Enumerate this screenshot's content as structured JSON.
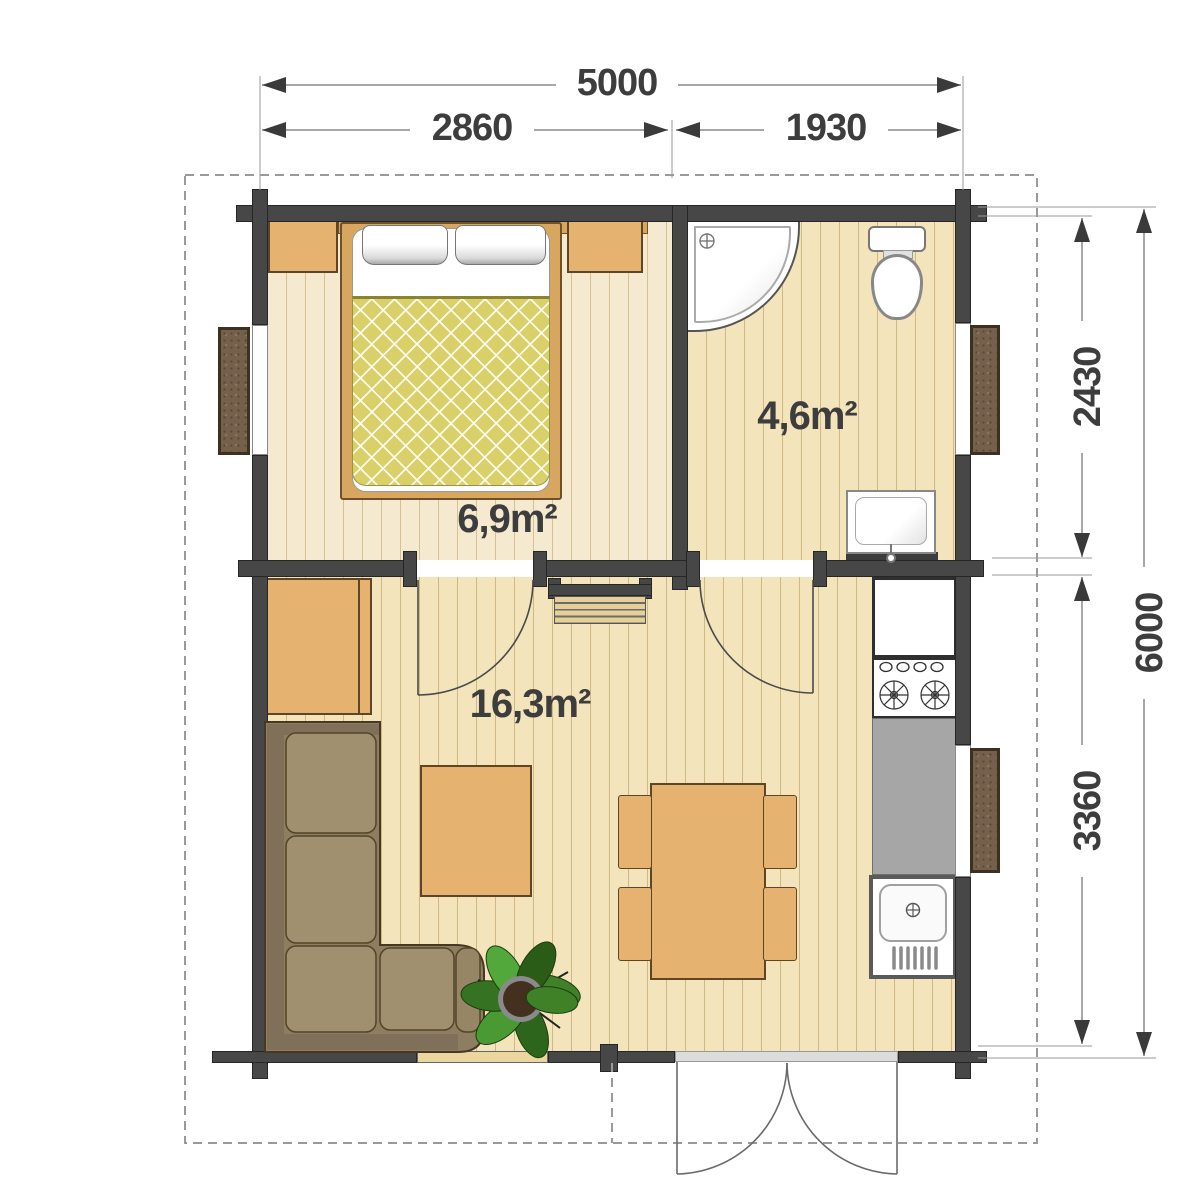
{
  "plan": {
    "rooms": {
      "bedroom": {
        "area_label": "6,9m²"
      },
      "bathroom": {
        "area_label": "4,6m²"
      },
      "living_room": {
        "area_label": "16,3m²"
      }
    },
    "dimensions": {
      "top_total": "5000",
      "top_left_span": "2860",
      "top_right_span": "1930",
      "right_upper_span": "2430",
      "right_lower_span": "3360",
      "right_total": "6000"
    },
    "colors": {
      "wall": "#474747",
      "floor_pale": "#f5ead0",
      "floor_gold": "#f3e4bc",
      "wood_furniture": "#e6b26f",
      "bed_blanket": "#d9d06a",
      "sofa": "#a09070",
      "counter_top": "#a6a6a6",
      "window_shutter": "#75604b",
      "dimension_text": "#3d3d3d"
    }
  }
}
